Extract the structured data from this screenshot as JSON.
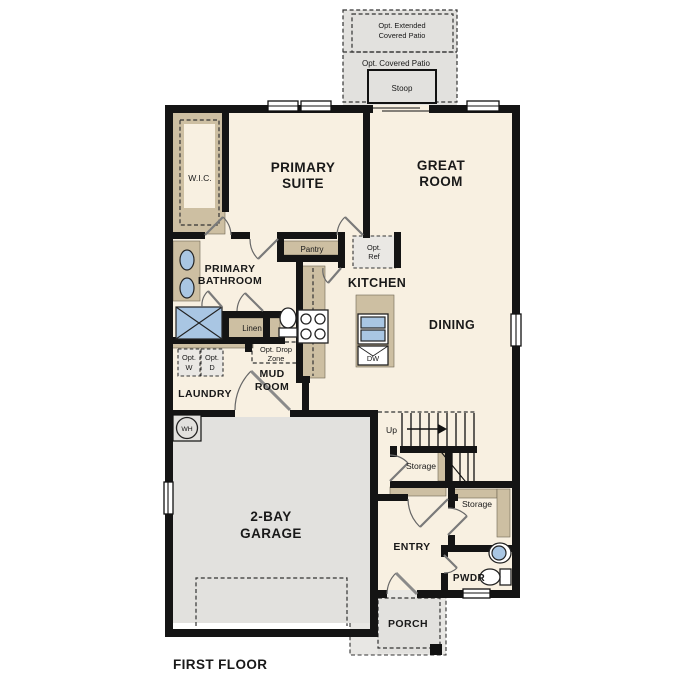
{
  "title": "FIRST FLOOR",
  "colors": {
    "wall": "#141414",
    "interior": "#f8f0e1",
    "cabinet": "#cdbfa2",
    "outdoor": "#e2e1de",
    "optional": "#eae8e4",
    "fixture": "#a9c6e3"
  },
  "outdoor": {
    "extended_patio_line1": "Opt. Extended",
    "extended_patio_line2": "Covered Patio",
    "covered_patio": "Opt. Covered Patio",
    "stoop": "Stoop",
    "porch": "PORCH"
  },
  "rooms": {
    "wic": "W.I.C.",
    "primary_suite_line1": "PRIMARY",
    "primary_suite_line2": "SUITE",
    "great_room_line1": "GREAT",
    "great_room_line2": "ROOM",
    "primary_bathroom_line1": "PRIMARY",
    "primary_bathroom_line2": "BATHROOM",
    "kitchen": "KITCHEN",
    "dining": "DINING",
    "mud_room_line1": "MUD",
    "mud_room_line2": "ROOM",
    "laundry": "LAUNDRY",
    "garage_line1": "2-BAY",
    "garage_line2": "GARAGE",
    "entry": "ENTRY",
    "pwdr": "PWDR"
  },
  "features": {
    "pantry": "Pantry",
    "opt_ref_line1": "Opt.",
    "opt_ref_line2": "Ref",
    "linen": "Linen",
    "opt_w_line1": "Opt.",
    "opt_w_line2": "W",
    "opt_d_line1": "Opt.",
    "opt_d_line2": "D",
    "opt_drop_zone_line1": "Opt. Drop",
    "opt_drop_zone_line2": "Zone",
    "water_heater": "WH",
    "up": "Up",
    "storage_under_stairs": "Storage",
    "storage_entry": "Storage",
    "dishwasher": "DW"
  }
}
